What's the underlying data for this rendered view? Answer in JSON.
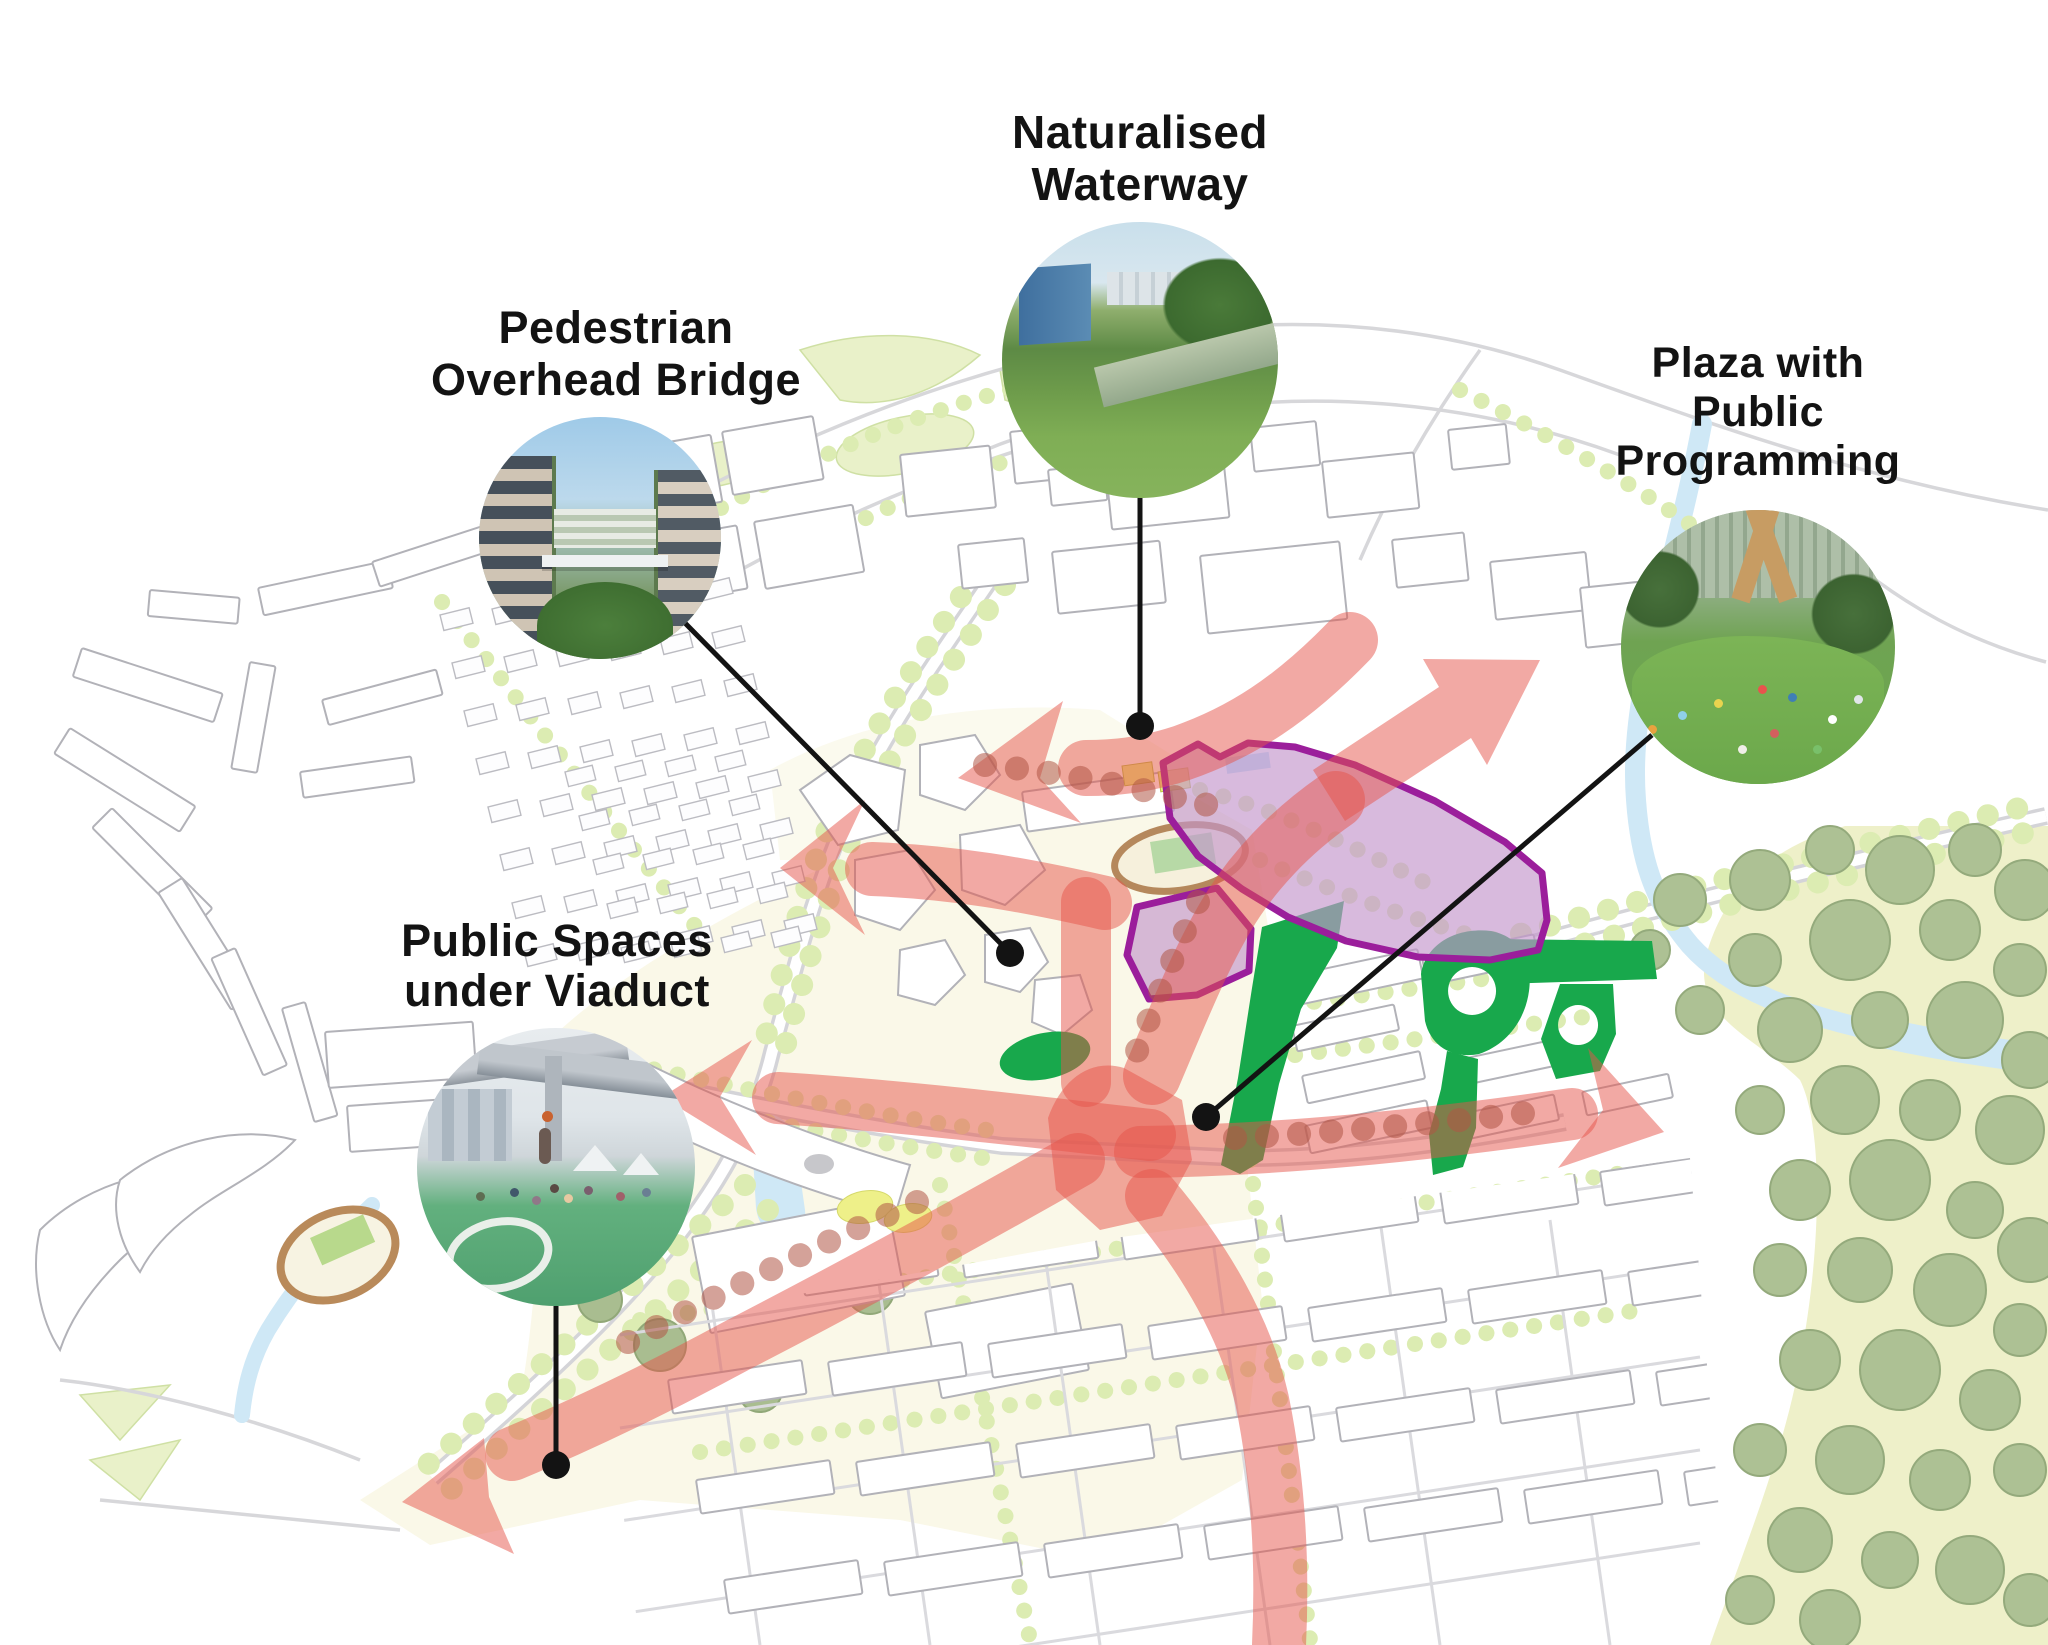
{
  "canvas": {
    "width": 2048,
    "height": 1645,
    "background": "#ffffff"
  },
  "diagram_type": "urban-masterplan-callout-diagram",
  "callouts": [
    {
      "id": "naturalised-waterway",
      "lines": [
        "Naturalised",
        "Waterway"
      ],
      "photo": "naturalised-waterway-photo"
    },
    {
      "id": "pedestrian-overhead-bridge",
      "lines": [
        "Pedestrian",
        "Overhead Bridge"
      ],
      "photo": "pedestrian-overhead-bridge-photo"
    },
    {
      "id": "plaza-with-public-programming",
      "lines": [
        "Plaza with",
        "Public",
        "Programming"
      ],
      "photo": "plaza-with-public-programming-photo"
    },
    {
      "id": "public-spaces-under-viaduct",
      "lines": [
        "Public Spaces",
        "under Viaduct"
      ],
      "photo": "public-spaces-under-viaduct-photo"
    }
  ],
  "map": {
    "legend_colors": {
      "pedestrian_flow_arrow": "#e85449",
      "development_parcel_border": "#9b1e9b",
      "development_parcel_fill": "#c496cc",
      "public_green_space": "#18a84c",
      "street_trees": "#dcecb2",
      "forest_trees": "#adc194",
      "water": "#cfe8f6",
      "town_centre_ground": "#faf8e8",
      "callout_marker": "#131313"
    }
  }
}
